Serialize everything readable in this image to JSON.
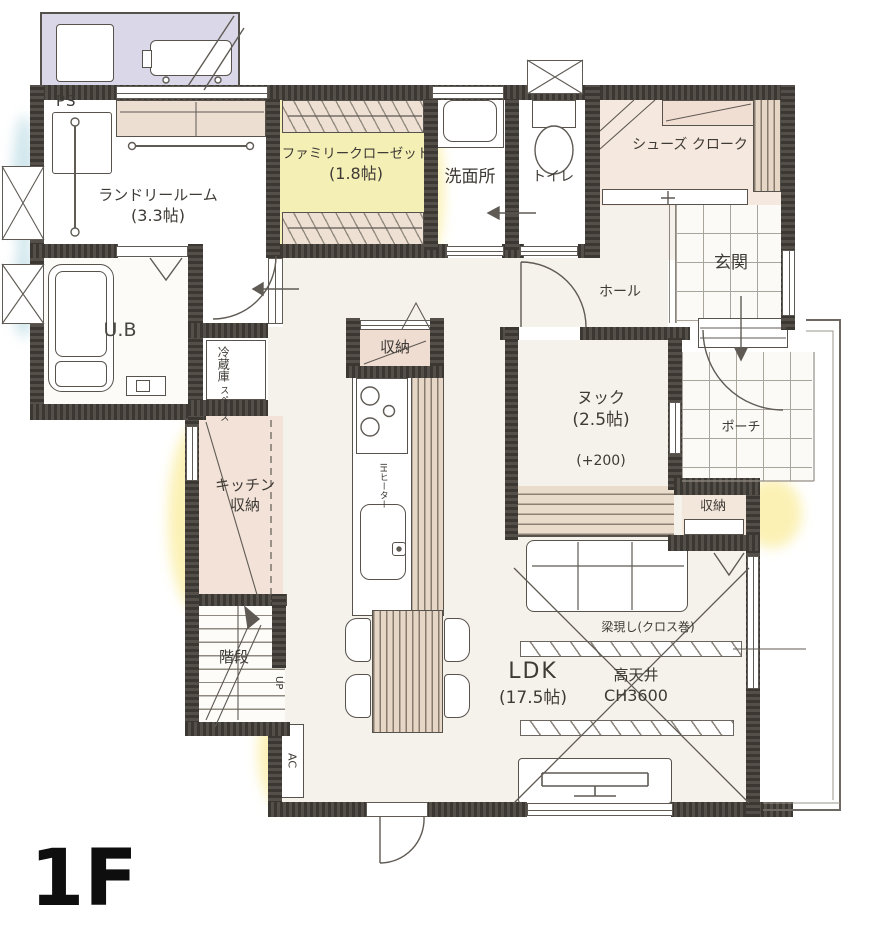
{
  "floor": {
    "label": "1F"
  },
  "rooms": {
    "ps": {
      "label": "PS"
    },
    "laundry": {
      "name": "ランドリールーム",
      "size": "(3.3帖)"
    },
    "family_closet": {
      "name": "ファミリークローゼット",
      "size": "(1.8帖)"
    },
    "washroom": {
      "name": "洗面所"
    },
    "toilet": {
      "name": "トイレ"
    },
    "shoes_cloak": {
      "name": "シューズ クローク"
    },
    "genkan": {
      "name": "玄関"
    },
    "hall": {
      "name": "ホール"
    },
    "porch": {
      "name": "ポーチ"
    },
    "unit_bath": {
      "name": "U.B"
    },
    "fridge_space": {
      "line1": "冷蔵庫",
      "line2": "スペース"
    },
    "kitchen_closet": {
      "name": "収納"
    },
    "kitchen": {
      "ih": "IHヒーター"
    },
    "kitchen_storage": {
      "line1": "キッチン",
      "line2": "収納"
    },
    "stairs": {
      "name": "階段",
      "up": "UP"
    },
    "nook": {
      "name": "ヌック",
      "size": "(2.5帖)",
      "floor_height": "(+200)"
    },
    "nook_closet": {
      "name": "収納"
    },
    "ldk": {
      "name": "LDK",
      "size": "(17.5帖)",
      "ceiling1": "高天井",
      "ceiling2": "CH3600",
      "beam": "梁現し(クロス巻)"
    },
    "ac": {
      "label": "AC"
    }
  },
  "colors": {
    "wall": "#474340",
    "tile_teal": "#d3e3e5",
    "closet_yellow": "#f4efb5",
    "room_pink": "#f2e2d8",
    "wood": "#e6d6c5",
    "exterior_pad": "#dad8e8",
    "floor": "#f5f1eb"
  }
}
